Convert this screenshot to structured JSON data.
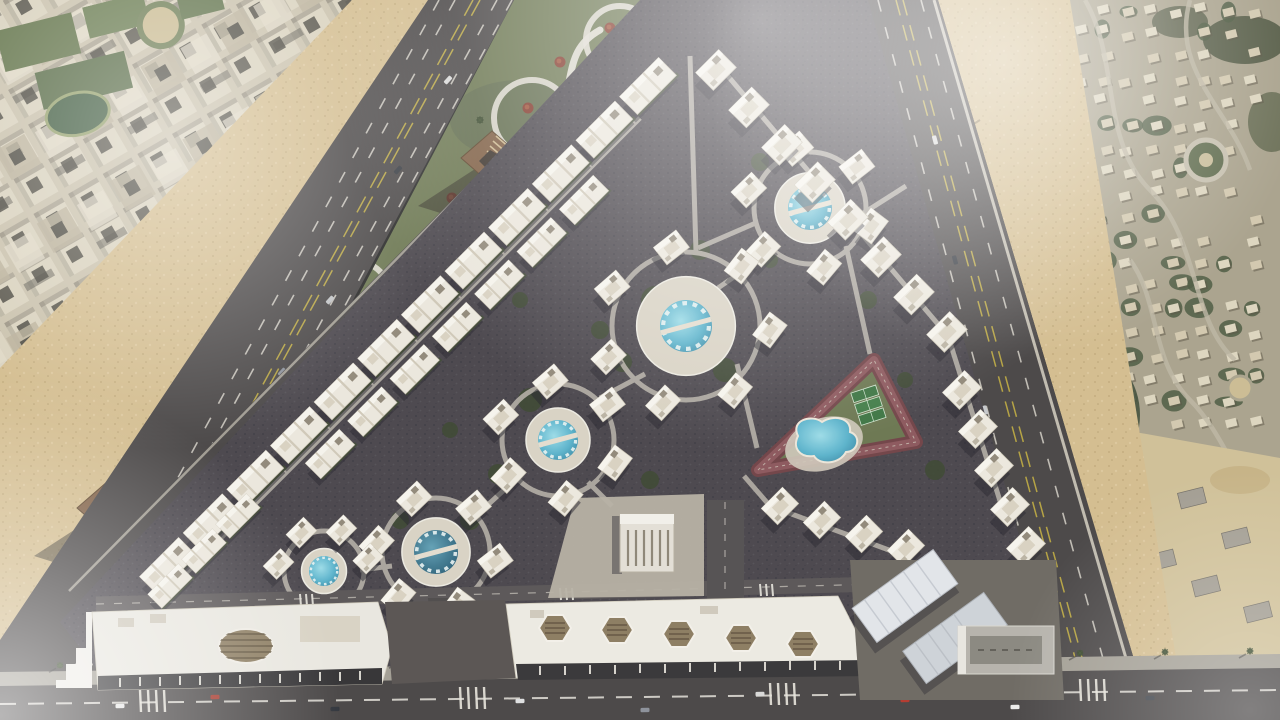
{
  "scene": {
    "type": "aerial-masterplan-render",
    "description": "Aerial 3D render of a triangular gated residential compound with white villa clusters around circular pools, a triangular running track with lagoon pool and sports courts, a green landscaped belt with winding paths and pyramid entrance gates, and a retail strip along the bottom boulevard, composited over satellite imagery of surrounding city districts and desert land",
    "regions": {
      "top_left": "dense urban grid of beige apartment blocks with parks",
      "left_belt": "landscaped green strip with winding white paths, red trees and three pyramid gate pavilions",
      "center": "triangular compound of white villas in radial clusters around circular swimming pools",
      "right_inner": "triangular jogging track enclosing a lagoon pool and three green sports courts",
      "bottom": "retail mall buildings with louvered roof openings along a multi-lane boulevard",
      "right": "suburban neighborhood with curved streets, villas, vegetation and sandy construction plots"
    },
    "features": {
      "pool_clusters": 5,
      "entrance_gates": 3,
      "running_tracks": 1,
      "lagoon_pools": 1,
      "sports_courts": 3,
      "retail_buildings": 2,
      "warehouse_buildings": 2,
      "boulevards": 3
    }
  },
  "colors": {
    "pool": "#58b2cc",
    "poolDark": "#2e6f8a",
    "grass": "#68734d",
    "siteGround": "#47434a",
    "asphalt": "#454243",
    "sand": "#d3bc8e",
    "villa": "#ece8df",
    "track": "#6e3f44",
    "path": "#dfdbd2",
    "city": "#d9d1bd",
    "veg": "#49573e"
  }
}
